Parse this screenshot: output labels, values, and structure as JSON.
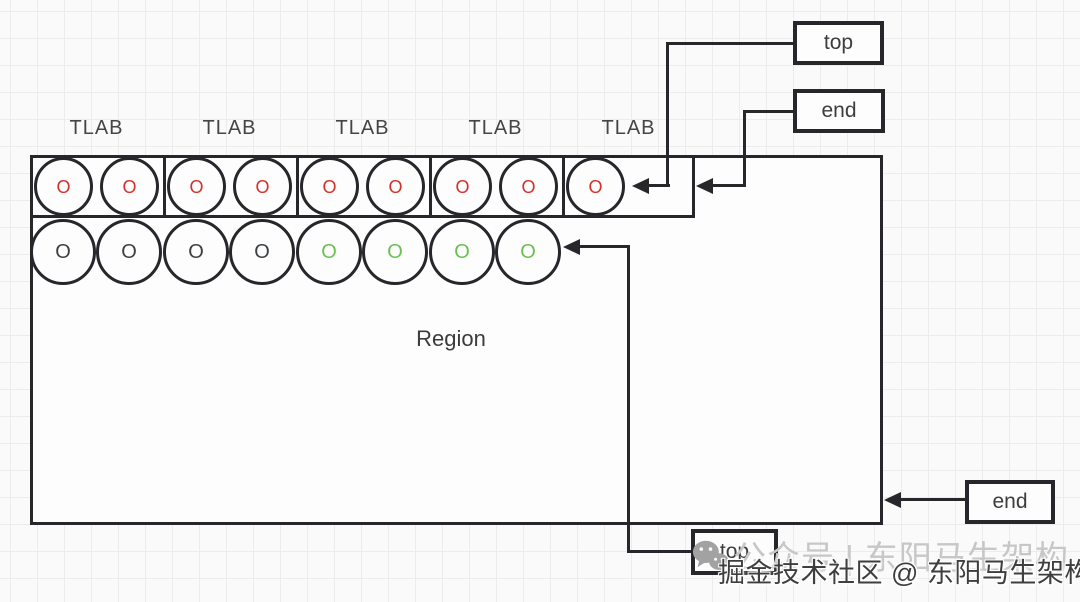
{
  "labels": {
    "tlab": [
      "TLAB",
      "TLAB",
      "TLAB",
      "TLAB",
      "TLAB"
    ],
    "region": "Region"
  },
  "pointer_boxes": {
    "top_tlab": "top",
    "end_tlab": "end",
    "top_region": "top",
    "end_region": "end"
  },
  "objects": {
    "tlab_row": [
      {
        "label": "O",
        "color": "#d4302c"
      },
      {
        "label": "O",
        "color": "#d4302c"
      },
      {
        "label": "O",
        "color": "#d4302c"
      },
      {
        "label": "O",
        "color": "#d4302c"
      },
      {
        "label": "O",
        "color": "#d4302c"
      },
      {
        "label": "O",
        "color": "#d4302c"
      },
      {
        "label": "O",
        "color": "#d4302c"
      },
      {
        "label": "O",
        "color": "#d4302c"
      },
      {
        "label": "O",
        "color": "#d4302c"
      }
    ],
    "region_row": [
      {
        "label": "O",
        "color": "#3d4043"
      },
      {
        "label": "O",
        "color": "#3d4043"
      },
      {
        "label": "O",
        "color": "#3d4043"
      },
      {
        "label": "O",
        "color": "#3d4043"
      },
      {
        "label": "O",
        "color": "#6cbf53"
      },
      {
        "label": "O",
        "color": "#6cbf53"
      },
      {
        "label": "O",
        "color": "#6cbf53"
      },
      {
        "label": "O",
        "color": "#6cbf53"
      }
    ]
  },
  "colors": {
    "stroke": "#26262b",
    "object_allocated": "#d4302c",
    "object_survived": "#6cbf53",
    "object_plain": "#3d4043"
  },
  "watermark": {
    "wechat_icon": "wechat-icon",
    "gray_text": "公众号 | 东阳马生架构",
    "main_text": "掘金技术社区 @ 东阳马生架构"
  }
}
